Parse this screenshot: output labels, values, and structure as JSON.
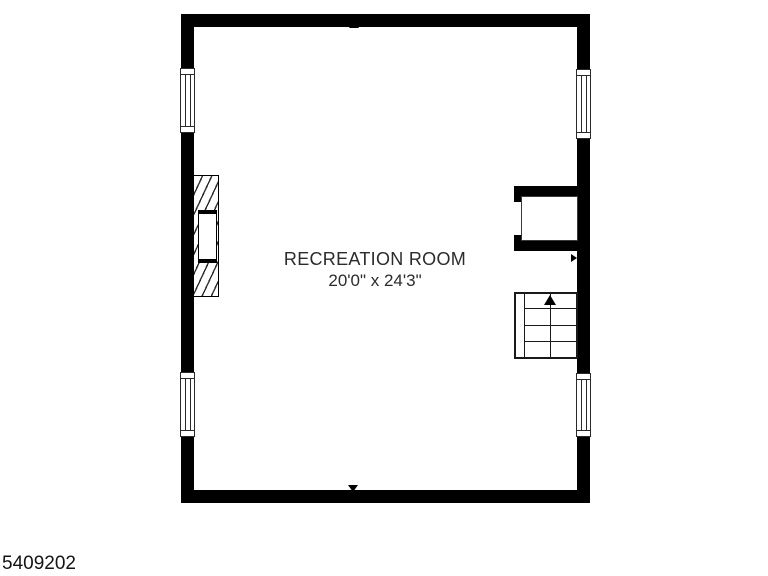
{
  "floorplan": {
    "room": {
      "name": "RECREATION ROOM",
      "dimensions": "20'0\" x 24'3\""
    },
    "listing_id": "5409202",
    "colors": {
      "wall": "#000000",
      "text": "#2b2b2b",
      "background": "#ffffff"
    },
    "symbols": {
      "windows": [
        "left-top",
        "left-bottom",
        "right-top",
        "right-bottom"
      ],
      "fireplace_marker": "left-triangle",
      "closet_door_marker": "right-triangle",
      "stairs": {
        "direction": "up",
        "treads": 4,
        "arrow": "up-arrow"
      },
      "entry_markers": [
        "top-up-triangle",
        "bottom-down-triangle"
      ]
    }
  }
}
